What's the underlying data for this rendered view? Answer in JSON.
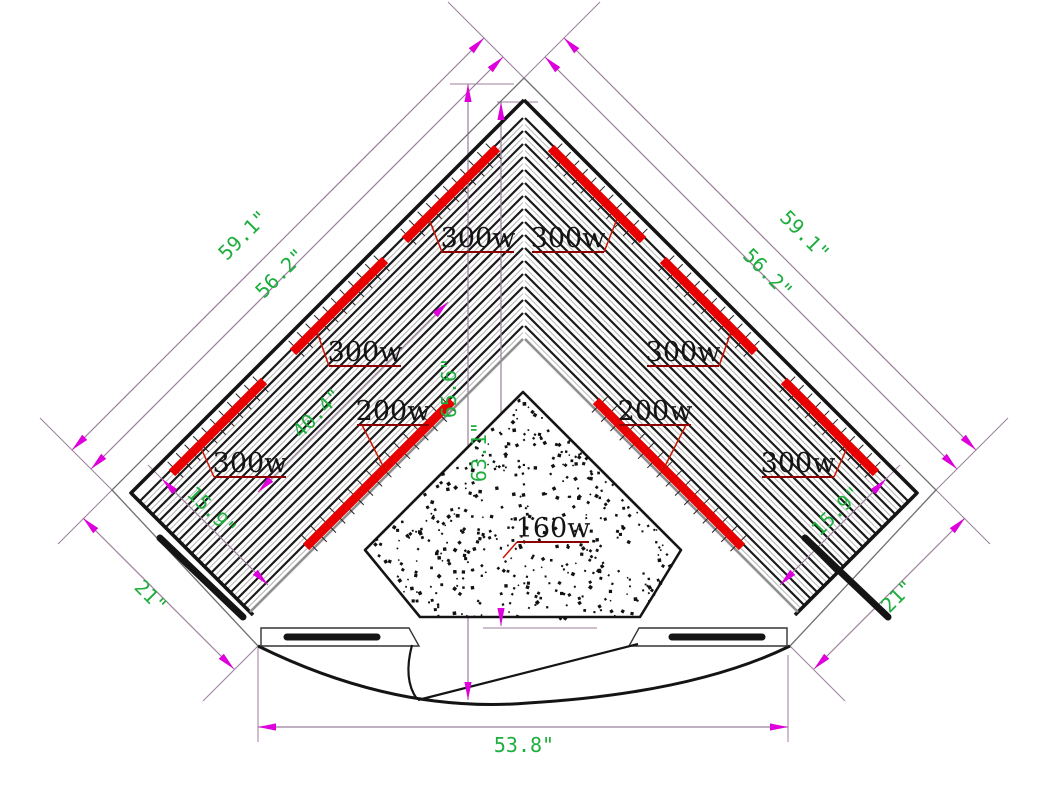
{
  "heater_labels": {
    "top_left": "300w",
    "top_right": "300w",
    "mid_left": "300w",
    "mid_right": "300w",
    "bench_left": "200w",
    "bench_right": "200w",
    "lower_left": "300w",
    "lower_right": "300w",
    "floor_center": "160w"
  },
  "dimensions": {
    "back_wall_outer_left": "59.1\"",
    "back_wall_inner_left": "56.2\"",
    "back_wall_outer_right": "59.1\"",
    "back_wall_inner_right": "56.2\"",
    "side_wall_left": "21\"",
    "side_wall_right": "21\"",
    "side_inner_left": "15.9\"",
    "side_inner_right": "15.9\"",
    "diagonal_depth": "40.4\"",
    "vertical_total": "65.6\"",
    "vertical_to_floor_heater": "63.1\"",
    "front_width": "53.8\""
  },
  "colors": {
    "heater_bar": "#e80000",
    "dimension_text": "#1eae3e",
    "arrow": "#dd00dd",
    "dimension_line": "#9b7f9b",
    "label_underline": "#8b0000",
    "label_leader": "#cc1100",
    "outline": "#141414",
    "slat": "#1a1a1a",
    "slat_thin": "#a8a8a8",
    "platform_edge": "#909090",
    "wall_outer": "#6e6e6e"
  }
}
